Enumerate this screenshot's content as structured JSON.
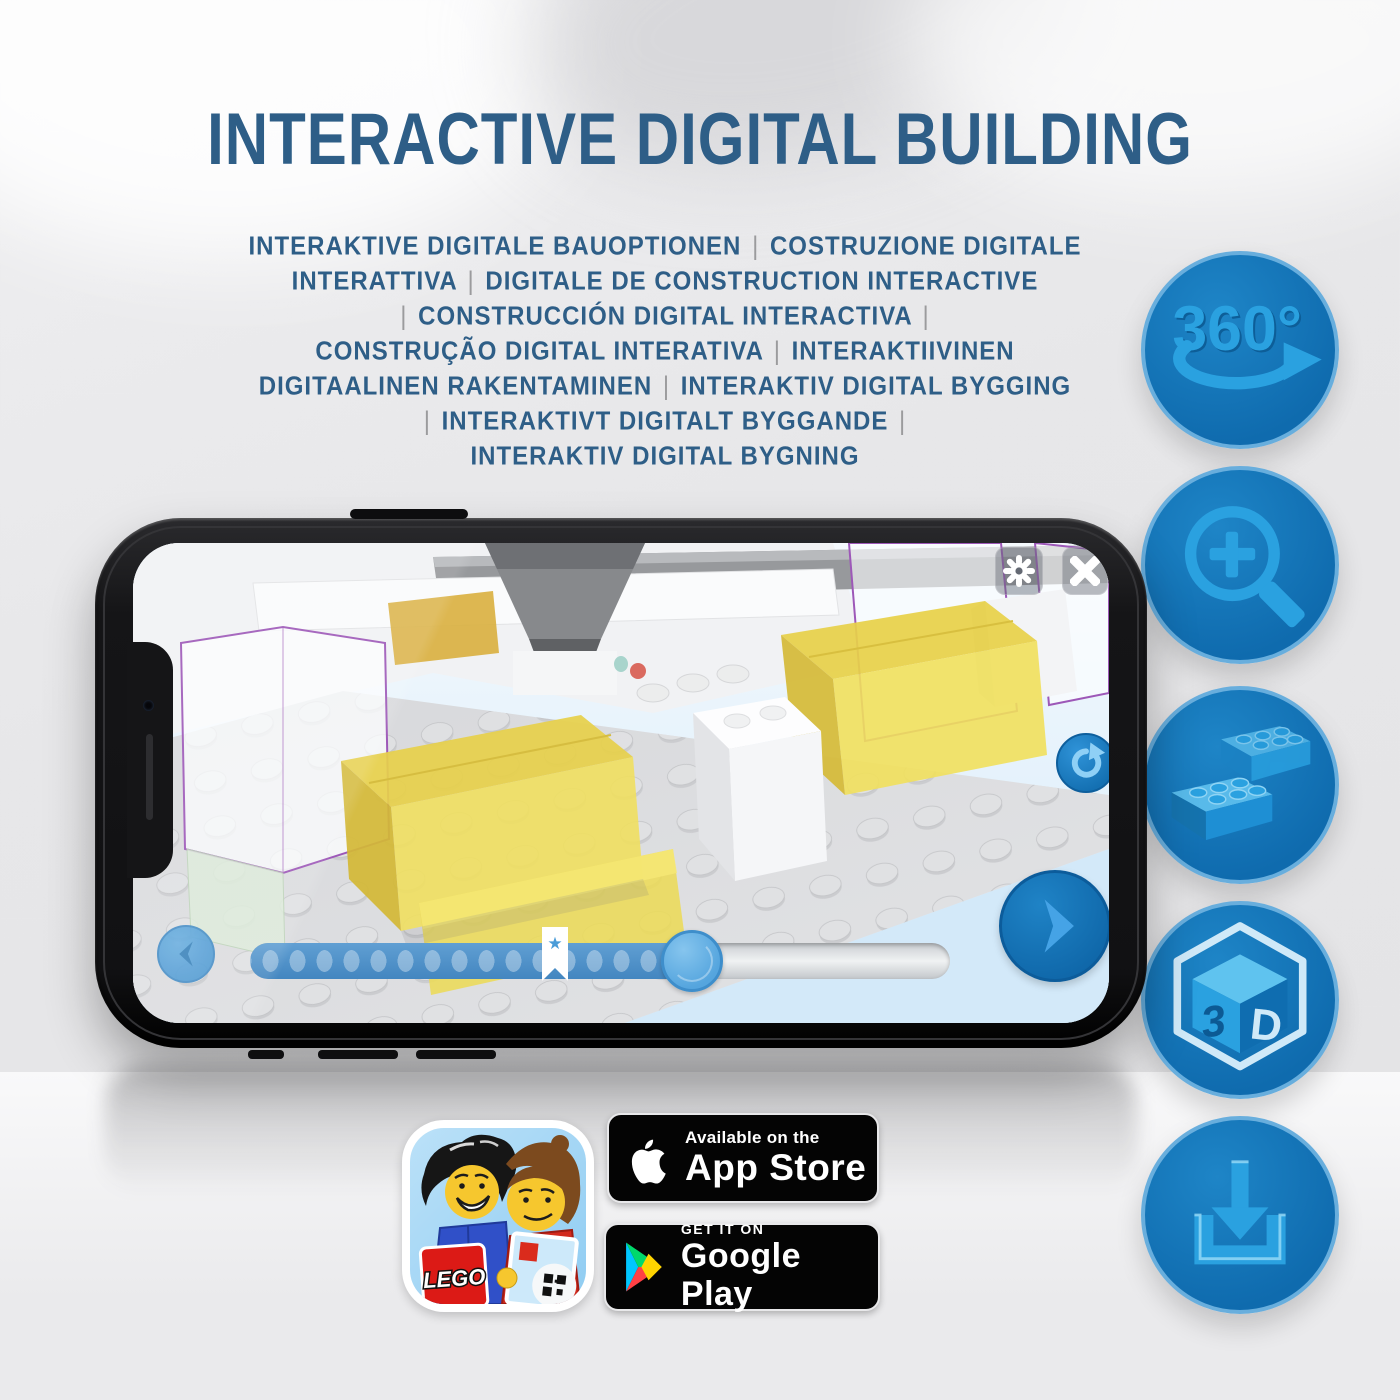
{
  "title": {
    "text": "INTERACTIVE DIGITAL BUILDING"
  },
  "subtitle": {
    "lines": [
      "INTERAKTIVE DIGITALE BAUOPTIONEN | COSTRUZIONE DIGITALE",
      "INTERATTIVA | DIGITALE DE CONSTRUCTION INTERACTIVE",
      "| CONSTRUCCIÓN DIGITAL INTERACTIVA |",
      "CONSTRUÇÃO DIGITAL INTERATIVA | INTERAKTIIVINEN",
      "DIGITAALINEN RAKENTAMINEN | INTERAKTIV DIGITAL BYGGING",
      "| INTERAKTIVT DIGITALT BYGGANDE |",
      "INTERAKTIV DIGITAL BYGNING"
    ]
  },
  "features": {
    "icons": [
      "360-rotation",
      "zoom-in",
      "lego-brick",
      "3d-view",
      "download"
    ],
    "rotation_label": "360°",
    "cube_label_left": "3",
    "cube_label_right": "D"
  },
  "phone": {
    "slider": {
      "bookmark_star": "★"
    }
  },
  "badges": {
    "app_store": {
      "line1": "Available on the",
      "line2": "App Store"
    },
    "google_play": {
      "line1": "GET IT ON",
      "line2": "Google Play"
    },
    "lego_icon": {
      "logo_text": "LEGO"
    }
  },
  "colors": {
    "title_blue": "#2e5e87",
    "circle_blue": "#1173b5",
    "icon_light_blue": "#2aa1e0",
    "brick_yellow": "#f0df5f",
    "outline_purple": "#9d58b8",
    "pipe_gray": "#9b9b9d"
  }
}
